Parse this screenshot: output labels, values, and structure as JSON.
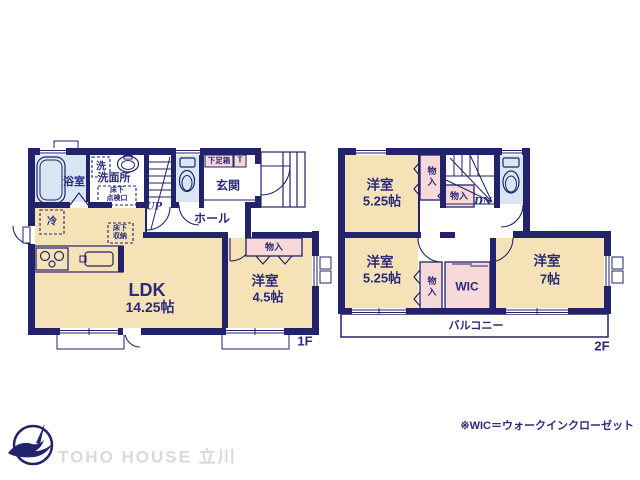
{
  "plan": {
    "floor1": {
      "floor_label": "1F",
      "labels": {
        "bathroom": "浴室",
        "laundry": "洗",
        "washroom": "洗面所",
        "underfloor_hatch": "床下\n点検口",
        "stairs": "UP",
        "shoe_box": "下足箱",
        "toilet_mark": "T",
        "entrance": "玄関",
        "hall": "ホール",
        "refrigerator": "冷",
        "underfloor_storage": "床下\n収納",
        "ldk": "LDK",
        "ldk_size": "14.25帖",
        "closet": "物入",
        "bedroom": "洋室",
        "bedroom_size": "4.5帖"
      }
    },
    "floor2": {
      "floor_label": "2F",
      "labels": {
        "bedroom_a": "洋室",
        "bedroom_a_size": "5.25帖",
        "closet_a": "物入",
        "closet_b": "物入",
        "stairs": "DN",
        "bedroom_b": "洋室",
        "bedroom_b_size": "5.25帖",
        "closet_c": "物入",
        "wic": "WIC",
        "bedroom_c": "洋室",
        "bedroom_c_size": "7帖",
        "balcony": "バルコニー"
      }
    }
  },
  "footer": {
    "brand": "TOHO HOUSE 立川",
    "note": "※WIC＝ウォークインクローゼット"
  },
  "colors": {
    "wall": "#23236b",
    "floor": "#f6e2b7",
    "wet_area": "#d9e7f4",
    "closet": "#f6d9d8",
    "text": "#2b2b7a",
    "brand_text": "#dadadc"
  }
}
